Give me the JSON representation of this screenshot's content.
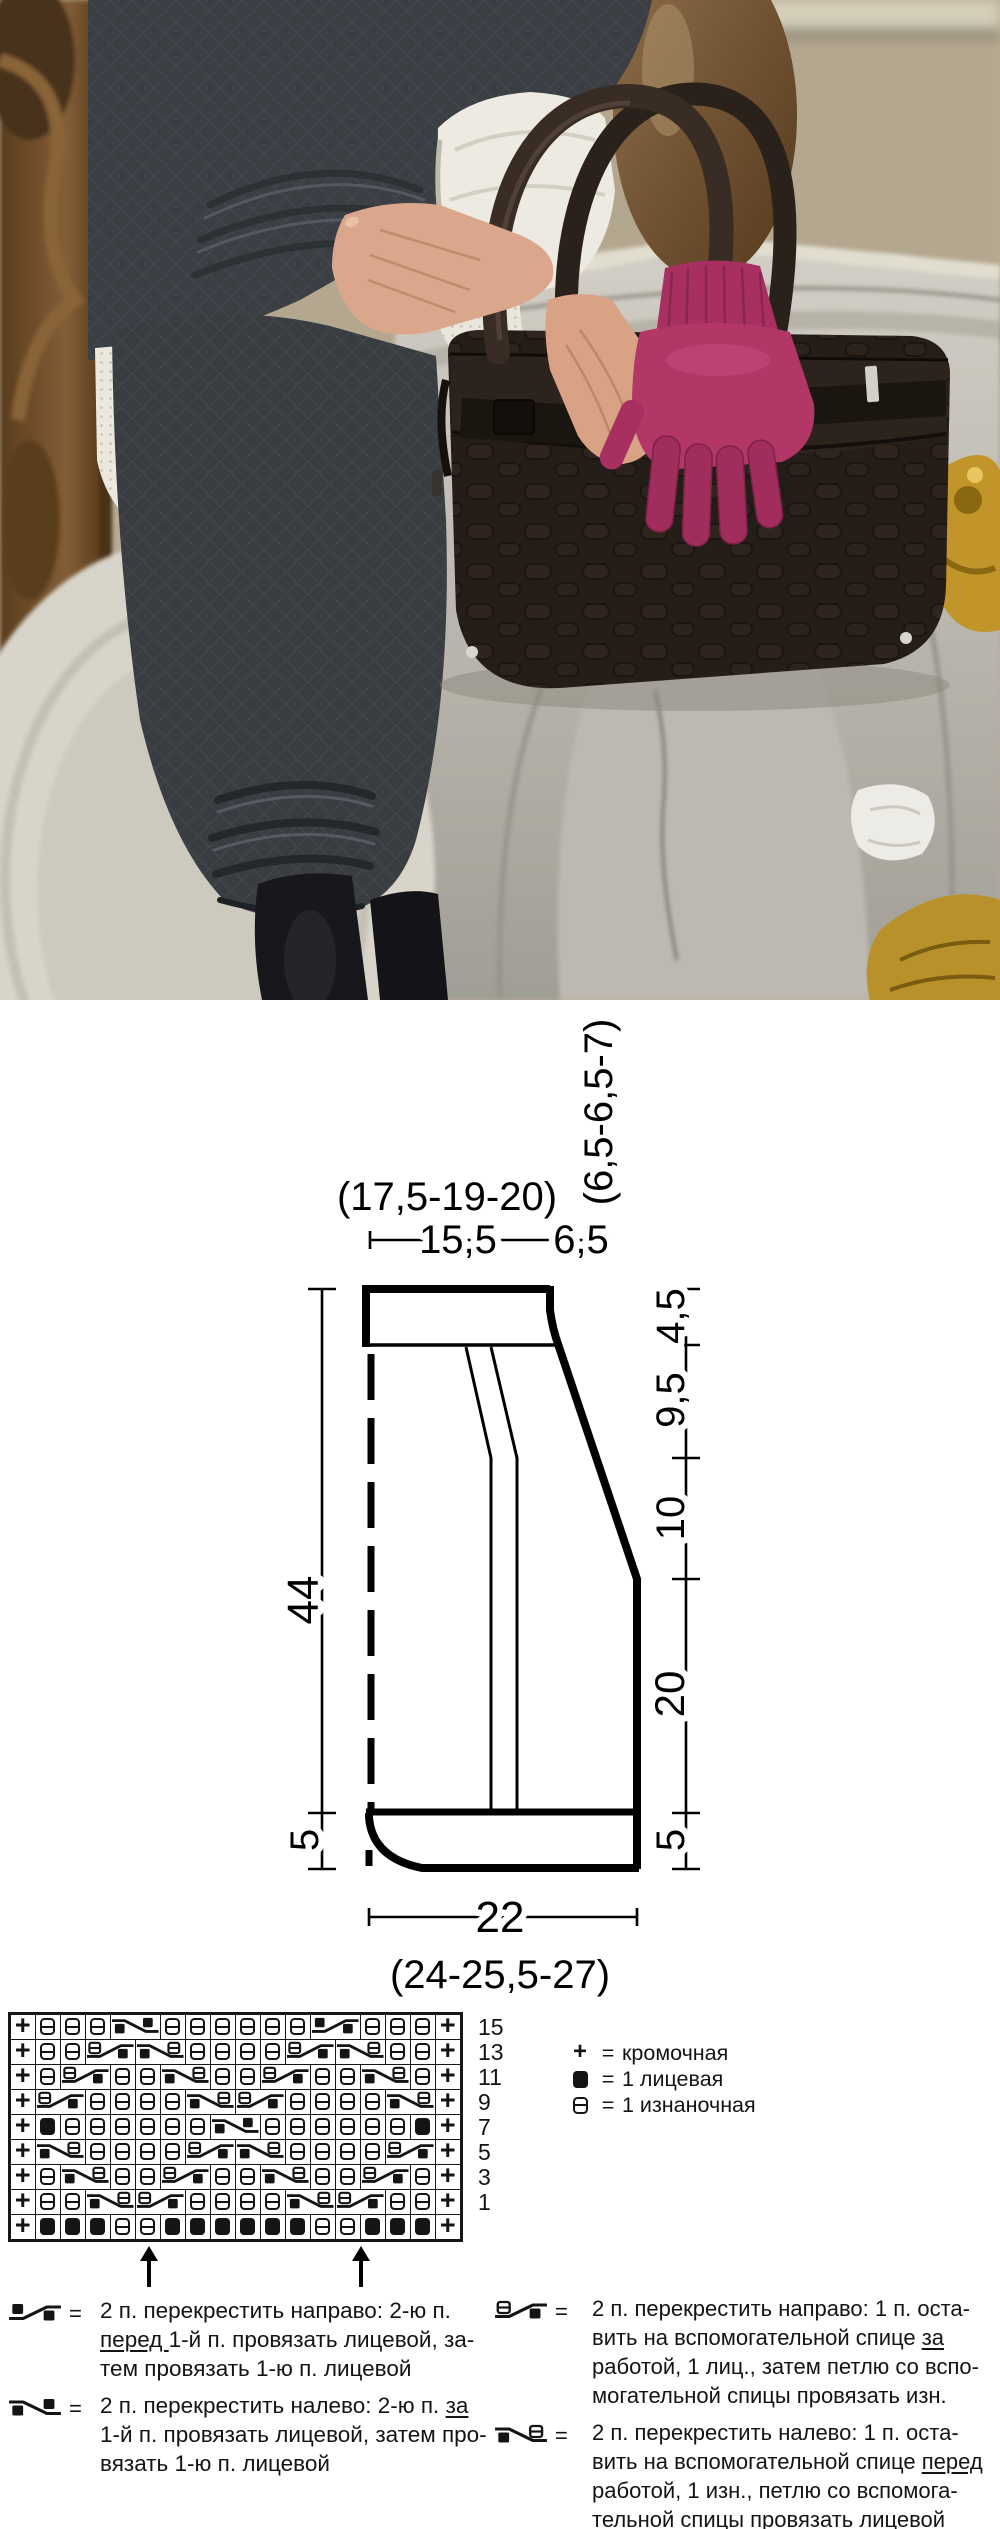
{
  "ui": {
    "eq_sign": "="
  },
  "photo": {
    "palette": {
      "stone": "#c6c2b9",
      "stone_shadow": "#a5a299",
      "bronze": "#6f4f2c",
      "gold": "#c2952a",
      "sweater": "#3b3e43",
      "skirt": "#393c41",
      "lace": "#ece8de",
      "blouse_cuff": "#edeae1",
      "skin": "#dba78c",
      "bag": "#251d18",
      "bag_handle": "#382c25",
      "gloves": "#b23767",
      "tights": "#18171c",
      "bridge": "#bfb098",
      "bridge_arch": "#5a5240",
      "water": "#8f978a"
    }
  },
  "schematic": {
    "top_sizes": "(17,5-19-20)",
    "top_width": "15,5",
    "top_shoulder": "6,5",
    "side_sizes": "(6,5-6,5-7)",
    "right_top": "4,5",
    "right_upper": "9,5",
    "right_middle": "10",
    "right_lower": "20",
    "right_hem": "5",
    "left_height": "44",
    "left_hem": "5",
    "bottom_width": "22",
    "bottom_sizes": "(24-25,5-27)"
  },
  "knitting_chart": {
    "columns": 18,
    "glyphs": {
      "edge": "+"
    },
    "row_numbers": [
      "15",
      "13",
      "11",
      "9",
      "7",
      "5",
      "3",
      "1"
    ],
    "rows": [
      [
        "E",
        "P",
        "P",
        "P",
        "LC",
        "P",
        "P",
        "P",
        "P",
        "P",
        "P",
        "RC",
        "P",
        "P",
        "P",
        "E"
      ],
      [
        "E",
        "P",
        "P",
        "RPC",
        "LPC",
        "P",
        "P",
        "P",
        "P",
        "RPC",
        "LPC",
        "P",
        "P",
        "E"
      ],
      [
        "E",
        "P",
        "RPC",
        "P",
        "P",
        "LPC",
        "P",
        "P",
        "RPC",
        "P",
        "P",
        "LPC",
        "P",
        "E"
      ],
      [
        "E",
        "RPC",
        "P",
        "P",
        "P",
        "P",
        "LPC",
        "RPC",
        "P",
        "P",
        "P",
        "P",
        "LPC",
        "E"
      ],
      [
        "E",
        "K",
        "P",
        "P",
        "P",
        "P",
        "P",
        "P",
        "LC",
        "P",
        "P",
        "P",
        "P",
        "P",
        "P",
        "K",
        "E"
      ],
      [
        "E",
        "LPC",
        "P",
        "P",
        "P",
        "P",
        "RPC",
        "LPC",
        "P",
        "P",
        "P",
        "P",
        "RPC",
        "E"
      ],
      [
        "E",
        "P",
        "LPC",
        "P",
        "P",
        "RPC",
        "P",
        "P",
        "LPC",
        "P",
        "P",
        "RPC",
        "P",
        "E"
      ],
      [
        "E",
        "P",
        "P",
        "LPC",
        "RPC",
        "P",
        "P",
        "P",
        "P",
        "LPC",
        "RPC",
        "P",
        "P",
        "E"
      ],
      [
        "E",
        "K",
        "K",
        "K",
        "P",
        "P",
        "K",
        "K",
        "K",
        "K",
        "K",
        "K",
        "P",
        "P",
        "K",
        "K",
        "K",
        "E"
      ]
    ]
  },
  "legend": {
    "items": [
      {
        "symbol": "edge",
        "label": "кромочная"
      },
      {
        "symbol": "knit",
        "label": "1 лицевая"
      },
      {
        "symbol": "purl",
        "label": "1 изнаночная"
      }
    ]
  },
  "instructions": {
    "left": [
      {
        "symbol": "RC",
        "lines": [
          [
            {
              "t": "2 п. перекрестить направо: 2-ю п."
            }
          ],
          [
            {
              "t": "перед ",
              "u": true
            },
            {
              "t": "1-й п. провязать лицевой, за-"
            }
          ],
          [
            {
              "t": "тем провязать 1-ю п. лицевой"
            }
          ]
        ]
      },
      {
        "symbol": "LC",
        "lines": [
          [
            {
              "t": "2 п. перекрестить налево: 2-ю п. "
            },
            {
              "t": "за",
              "u": true
            }
          ],
          [
            {
              "t": "1-й п. провязать лицевой, затем про-"
            }
          ],
          [
            {
              "t": "вязать 1-ю п. лицевой"
            }
          ]
        ]
      }
    ],
    "right": [
      {
        "symbol": "RPC",
        "lines": [
          [
            {
              "t": "2 п. перекрестить направо: 1 п. оста-"
            }
          ],
          [
            {
              "t": "вить на вспомогательной спице "
            },
            {
              "t": "за",
              "u": true
            }
          ],
          [
            {
              "t": "работой, 1 лиц., затем петлю со вспо-"
            }
          ],
          [
            {
              "t": "могательной спицы провязать изн."
            }
          ]
        ]
      },
      {
        "symbol": "LPC",
        "lines": [
          [
            {
              "t": "2 п. перекрестить налево: 1 п. оста-"
            }
          ],
          [
            {
              "t": "вить на вспомогательной спице "
            },
            {
              "t": "перед",
              "u": true
            }
          ],
          [
            {
              "t": "работой, 1 изн., петлю со вспомога-"
            }
          ],
          [
            {
              "t": "тельной спицы провязать лицевой"
            }
          ]
        ]
      }
    ]
  }
}
